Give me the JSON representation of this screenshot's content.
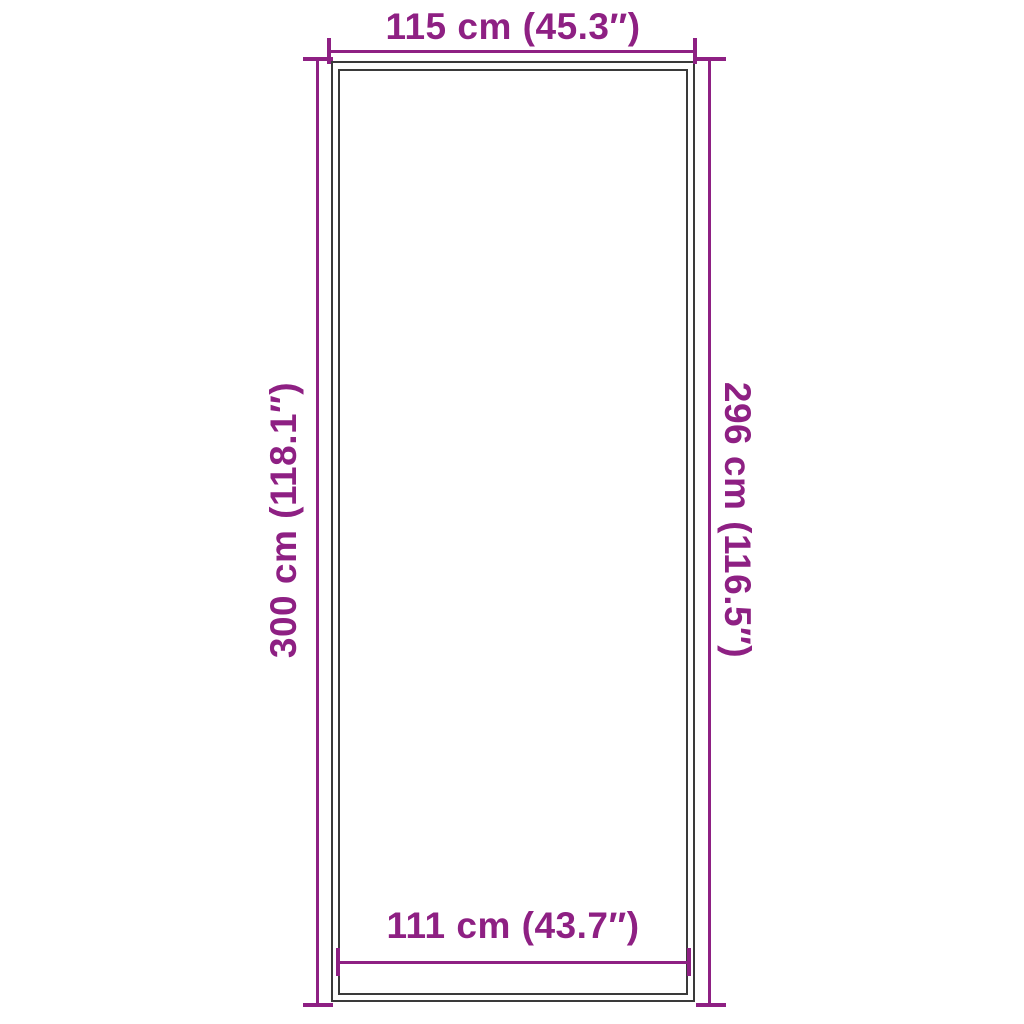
{
  "diagram": {
    "labels": {
      "top": "115 cm (45.3″)",
      "left": "300 cm (118.1″)",
      "right": "296 cm (116.5″)",
      "bottom": "111 cm (43.7″)"
    },
    "colors": {
      "accent": "#8E2083",
      "frame": "#3A3A3A",
      "background": "#FFFFFF"
    }
  }
}
